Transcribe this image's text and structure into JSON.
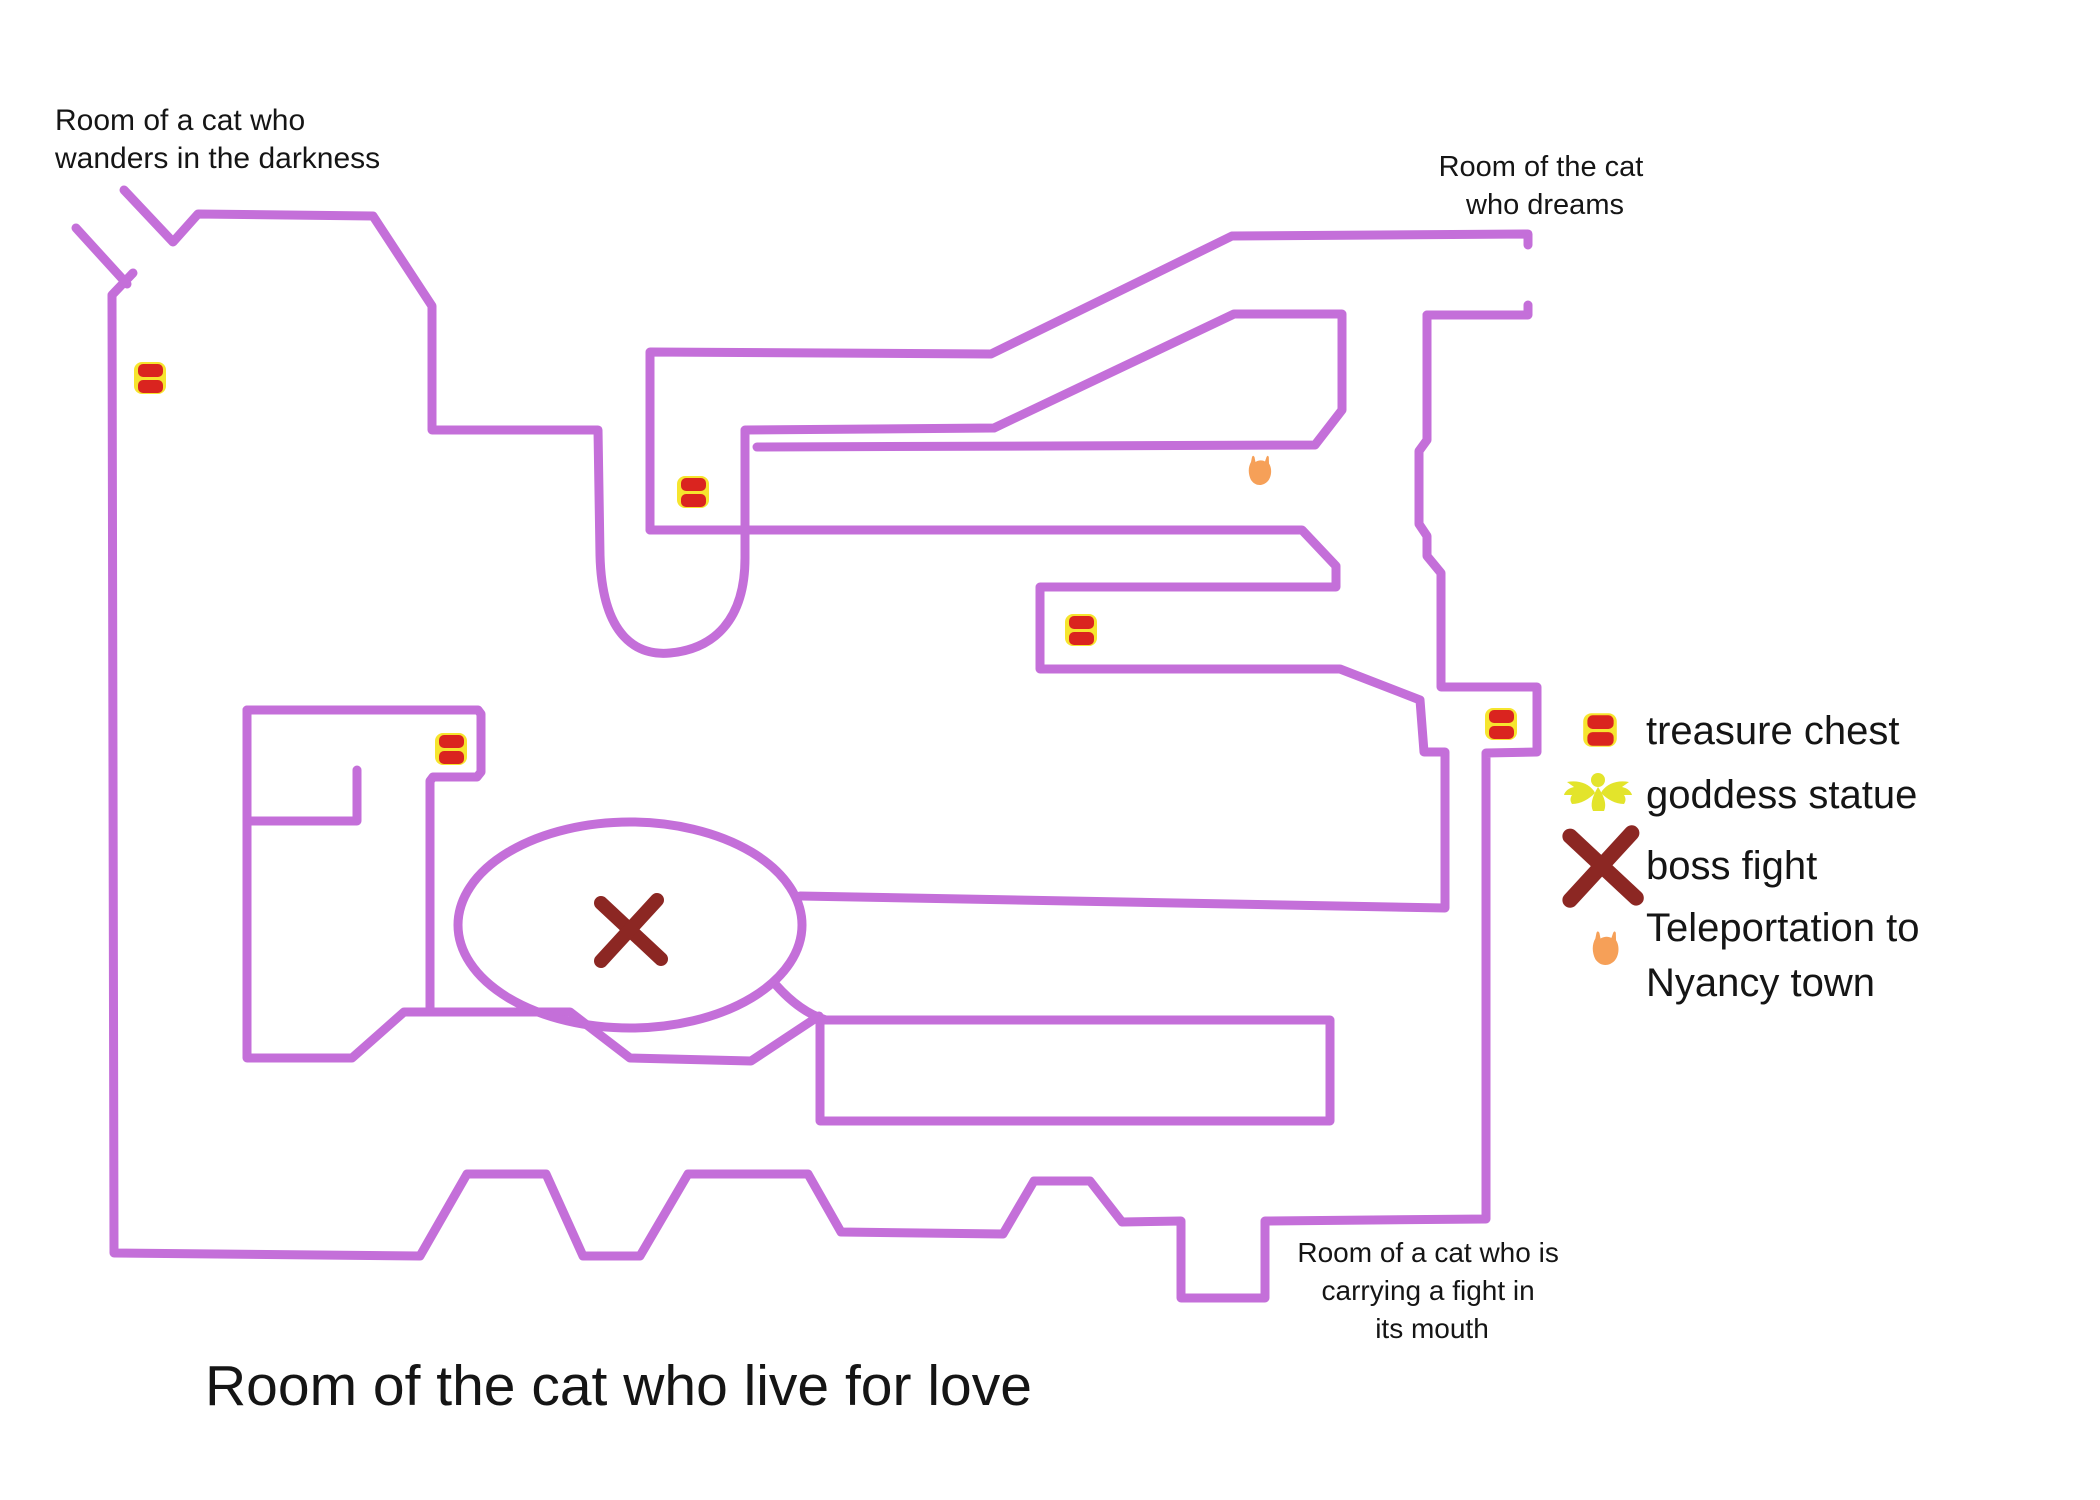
{
  "map": {
    "wall_color": "#c46fd9",
    "background": "#ffffff",
    "labels": [
      {
        "id": "room-wanders",
        "lines": [
          "Room of a cat who",
          "wanders in the darkness"
        ]
      },
      {
        "id": "room-dreams",
        "lines": [
          "Room of the cat",
          "who dreams"
        ]
      },
      {
        "id": "room-fight",
        "lines": [
          "Room of a cat who is",
          "carrying a fight in",
          "its mouth"
        ]
      },
      {
        "id": "room-love-title",
        "lines": [
          "Room of the cat who live for love"
        ]
      }
    ],
    "markers": [
      {
        "type": "treasure-chest",
        "x": 150,
        "y": 378
      },
      {
        "type": "treasure-chest",
        "x": 693,
        "y": 492
      },
      {
        "type": "treasure-chest",
        "x": 451,
        "y": 749
      },
      {
        "type": "treasure-chest",
        "x": 1081,
        "y": 630
      },
      {
        "type": "treasure-chest",
        "x": 1501,
        "y": 724
      },
      {
        "type": "boss-fight",
        "x": 630,
        "y": 930
      },
      {
        "type": "teleport",
        "x": 1262,
        "y": 472
      }
    ]
  },
  "legend": {
    "items": [
      {
        "icon": "treasure-chest-icon",
        "label": "treasure chest"
      },
      {
        "icon": "goddess-statue-icon",
        "label": "goddess statue"
      },
      {
        "icon": "boss-fight-icon",
        "label": "boss fight"
      },
      {
        "icon": "teleport-icon",
        "label": "Teleportation to",
        "label_line2": "Nyancy town"
      }
    ]
  },
  "colors": {
    "wall": "#c46fd9",
    "chest_red": "#da241f",
    "chest_yellow": "#f6e52e",
    "boss_x": "#8c2723",
    "teleport_orange": "#f6a058",
    "goddess_yellow": "#e3e42b",
    "text": "#151515"
  }
}
